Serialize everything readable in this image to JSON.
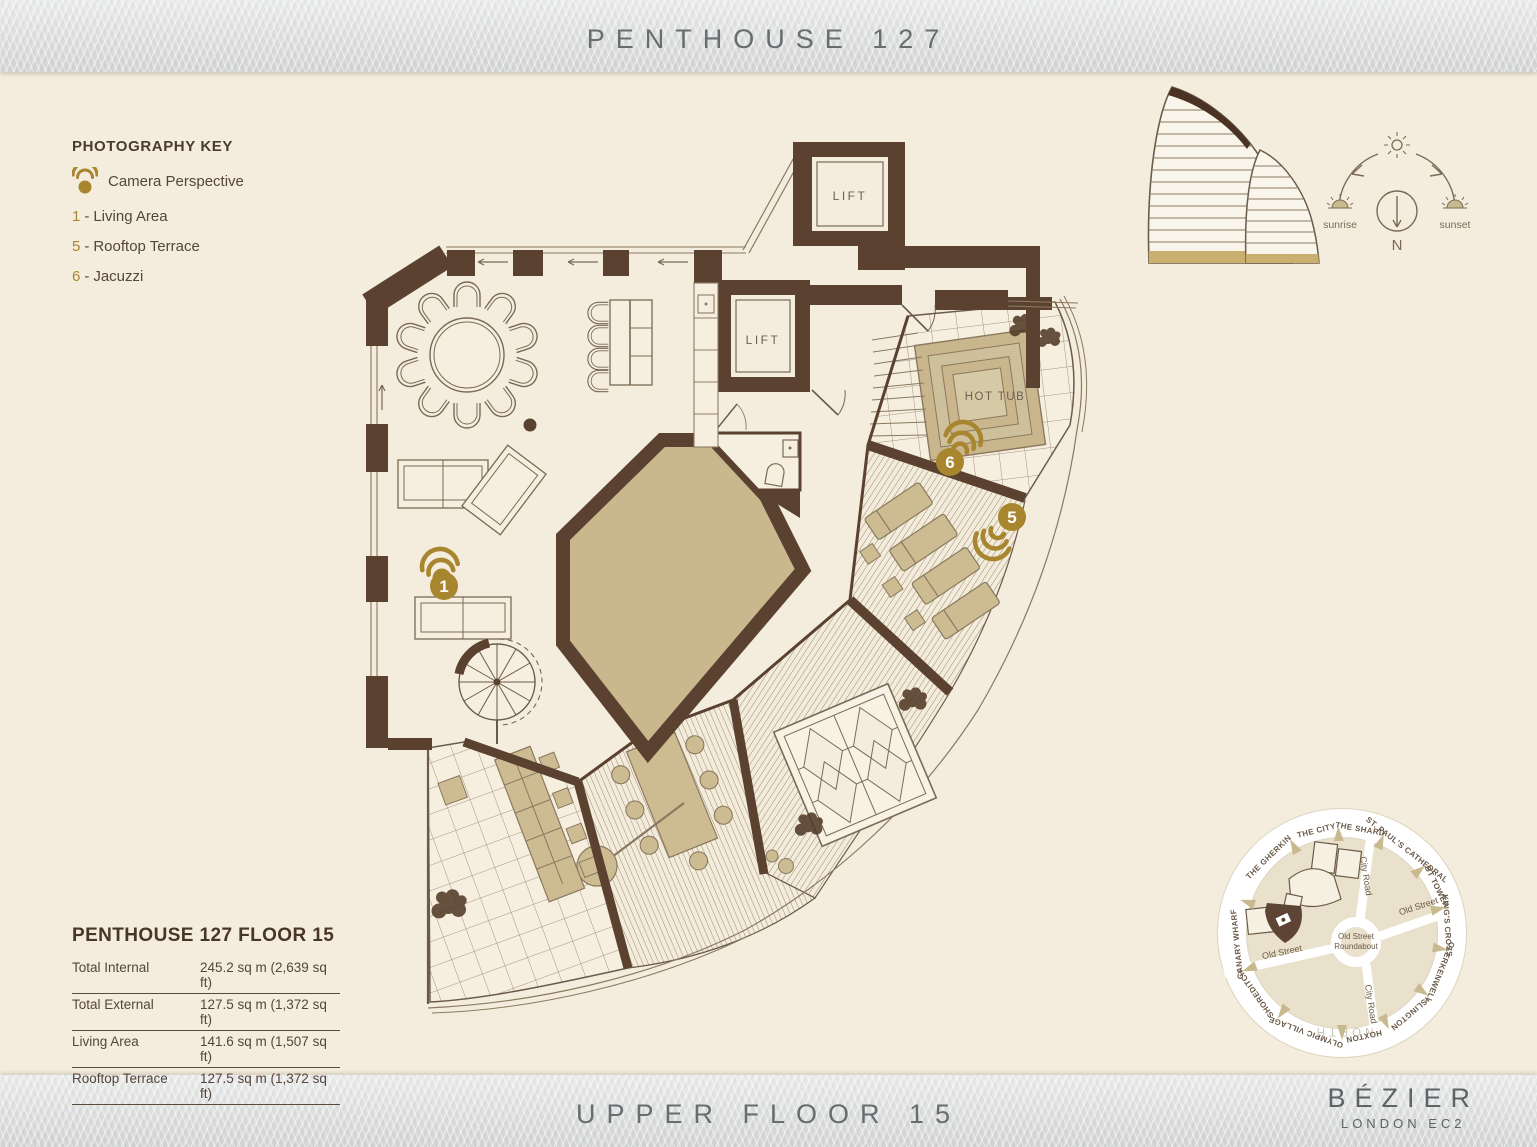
{
  "header": {
    "title": "PENTHOUSE 127"
  },
  "key": {
    "heading": "PHOTOGRAPHY KEY",
    "camera_label": "Camera Perspective",
    "separator": "-",
    "items": [
      {
        "num": "1",
        "label": "Living Area"
      },
      {
        "num": "5",
        "label": "Rooftop Terrace"
      },
      {
        "num": "6",
        "label": "Jacuzzi"
      }
    ]
  },
  "plan": {
    "lift_label": "LIFT",
    "hot_tub_label": "HOT TUB",
    "markers": [
      {
        "num": "1"
      },
      {
        "num": "5"
      },
      {
        "num": "6"
      }
    ]
  },
  "compass": {
    "sunrise": "sunrise",
    "sunset": "sunset",
    "north": "N"
  },
  "area_table": {
    "title": "PENTHOUSE 127 FLOOR 15",
    "rows": [
      {
        "label": "Total Internal",
        "value": "245.2 sq m (2,639 sq ft)"
      },
      {
        "label": "Total External",
        "value": "127.5 sq m (1,372 sq ft)"
      },
      {
        "label": "Living Area",
        "value": "141.6 sq m (1,507 sq ft)"
      },
      {
        "label": "Rooftop Terrace",
        "value": "127.5 sq m (1,372 sq ft)"
      }
    ]
  },
  "map": {
    "center_line1": "Old Street",
    "center_line2": "Roundabout",
    "road_city": "City Road",
    "road_old": "Old Street",
    "north_label": "NORTH",
    "landmarks": [
      "THE CITY",
      "THE SHARD",
      "ST. PAUL'S CATHEDRAL",
      "BT TOWER",
      "KING'S CROSS",
      "CLERKENWELL",
      "ISLINGTON",
      "HOXTON",
      "OLYMPIC VILLAGE",
      "SHOREDITCH",
      "CANARY WHARF",
      "THE GHERKIN"
    ]
  },
  "footer": {
    "floor_label": "UPPER FLOOR 15",
    "brand": "BÉZIER",
    "brand_sub": "LONDON EC2"
  },
  "colors": {
    "accent_gold": "#A8862F",
    "wall_brown": "#5A4130",
    "tan": "#C9B78E",
    "cream": "#F4EDDE"
  }
}
